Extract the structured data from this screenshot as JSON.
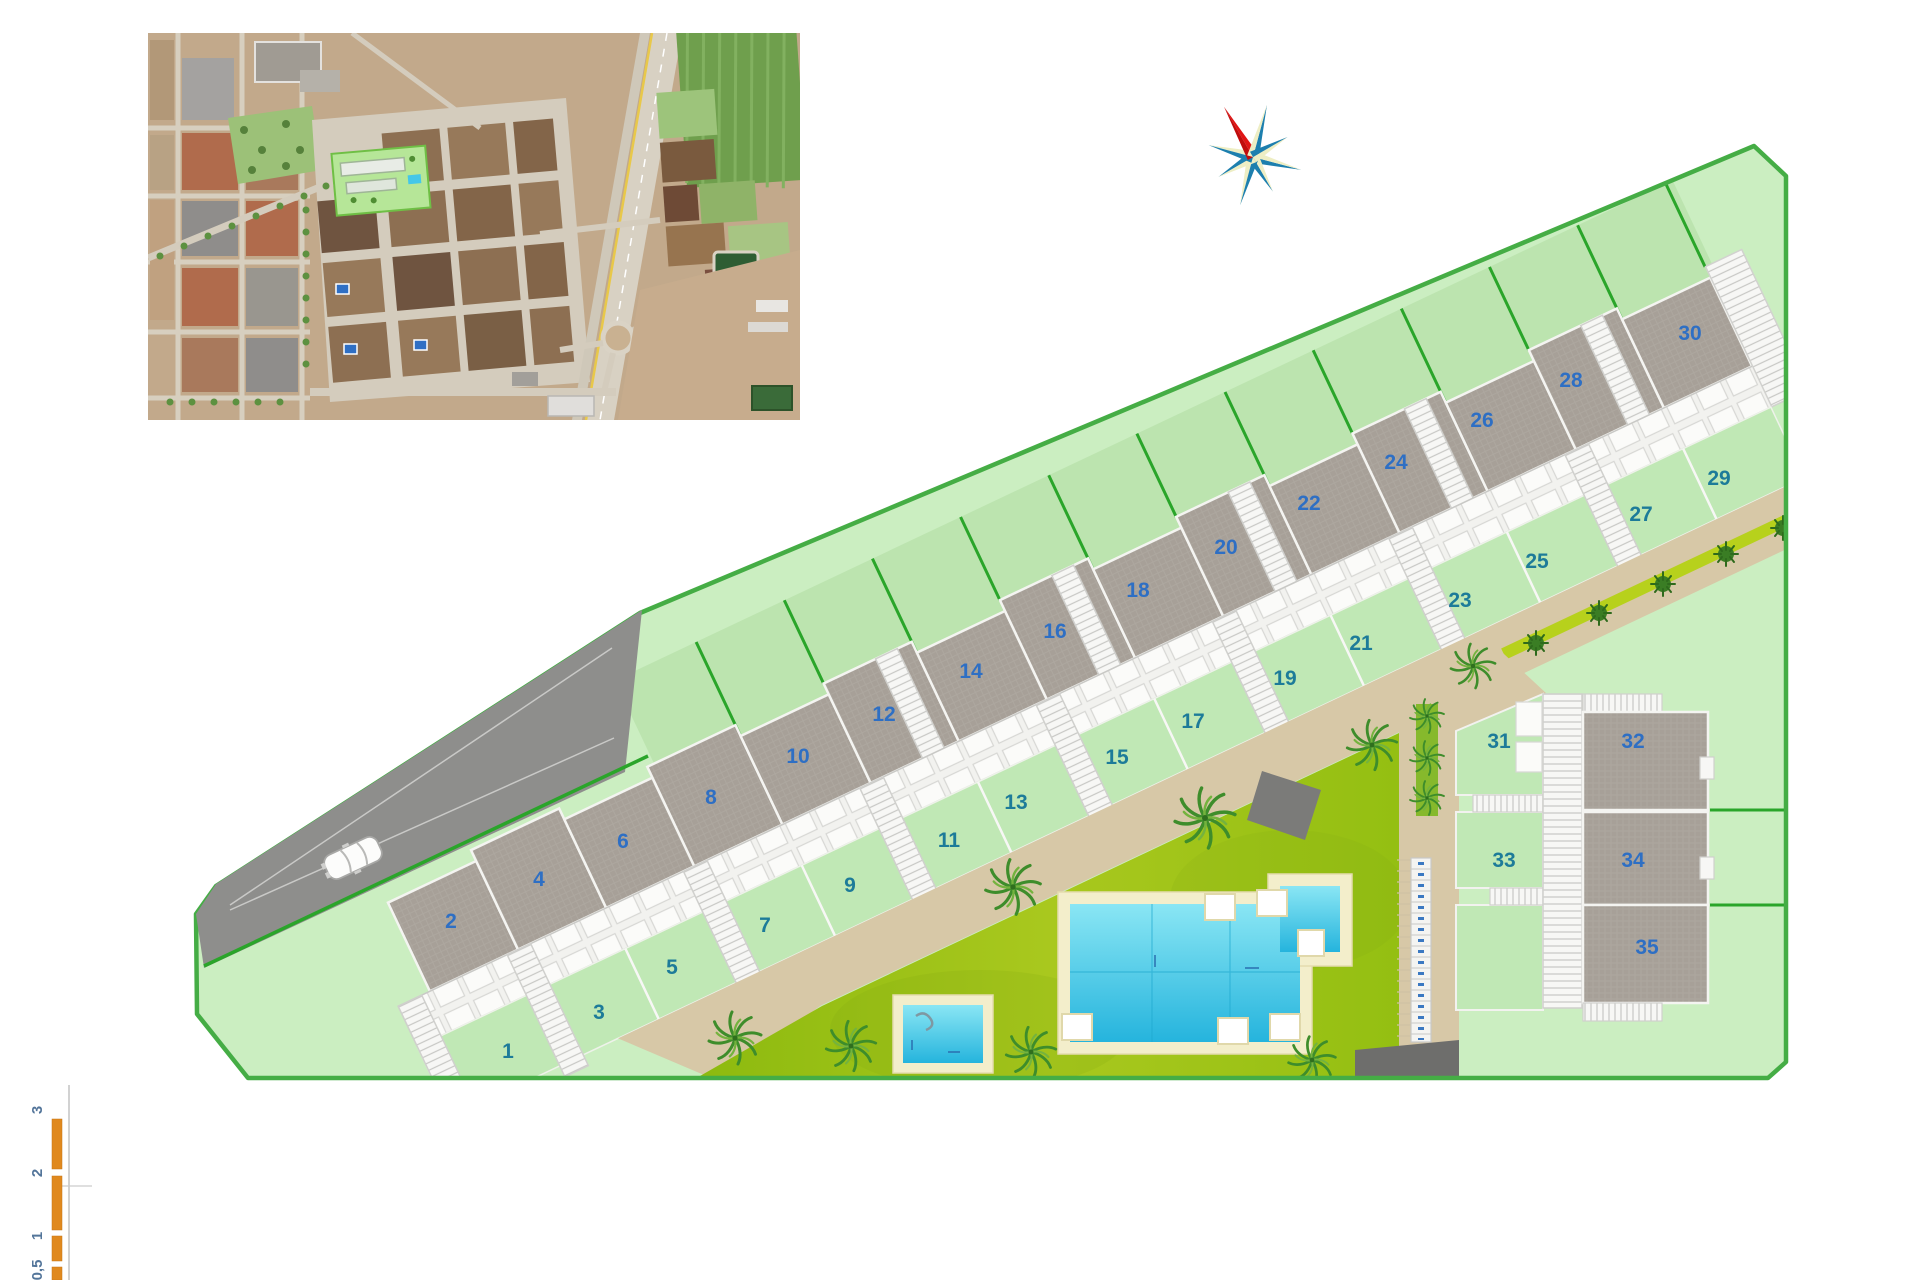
{
  "plots": {
    "labels": [
      "1",
      "2",
      "3",
      "4",
      "5",
      "6",
      "7",
      "8",
      "9",
      "10",
      "11",
      "12",
      "13",
      "14",
      "15",
      "16",
      "17",
      "18",
      "19",
      "20",
      "21",
      "22",
      "23",
      "24",
      "25",
      "26",
      "27",
      "28",
      "29",
      "30",
      "31",
      "32",
      "33",
      "34",
      "35"
    ]
  },
  "scale_bar": {
    "labels": [
      "3",
      "2",
      "1",
      "0,5"
    ],
    "bar_color": "#e0891e"
  },
  "colors": {
    "site_green": "#cbeec1",
    "boundary_green": "#45ad45",
    "back_garden_green": "#bce4af",
    "front_garden_green": "#c0e8b5",
    "roof_gray": "#a7a098",
    "lawn_olive": "#9cc115",
    "path_tan": "#d7c8a7",
    "pool_water": "#3cc6e8",
    "plot_number_blue": "#2e6fc4",
    "plot_number_teal": "#1d7b99",
    "compass_red": "#e01515",
    "compass_teal": "#1d7fae"
  }
}
